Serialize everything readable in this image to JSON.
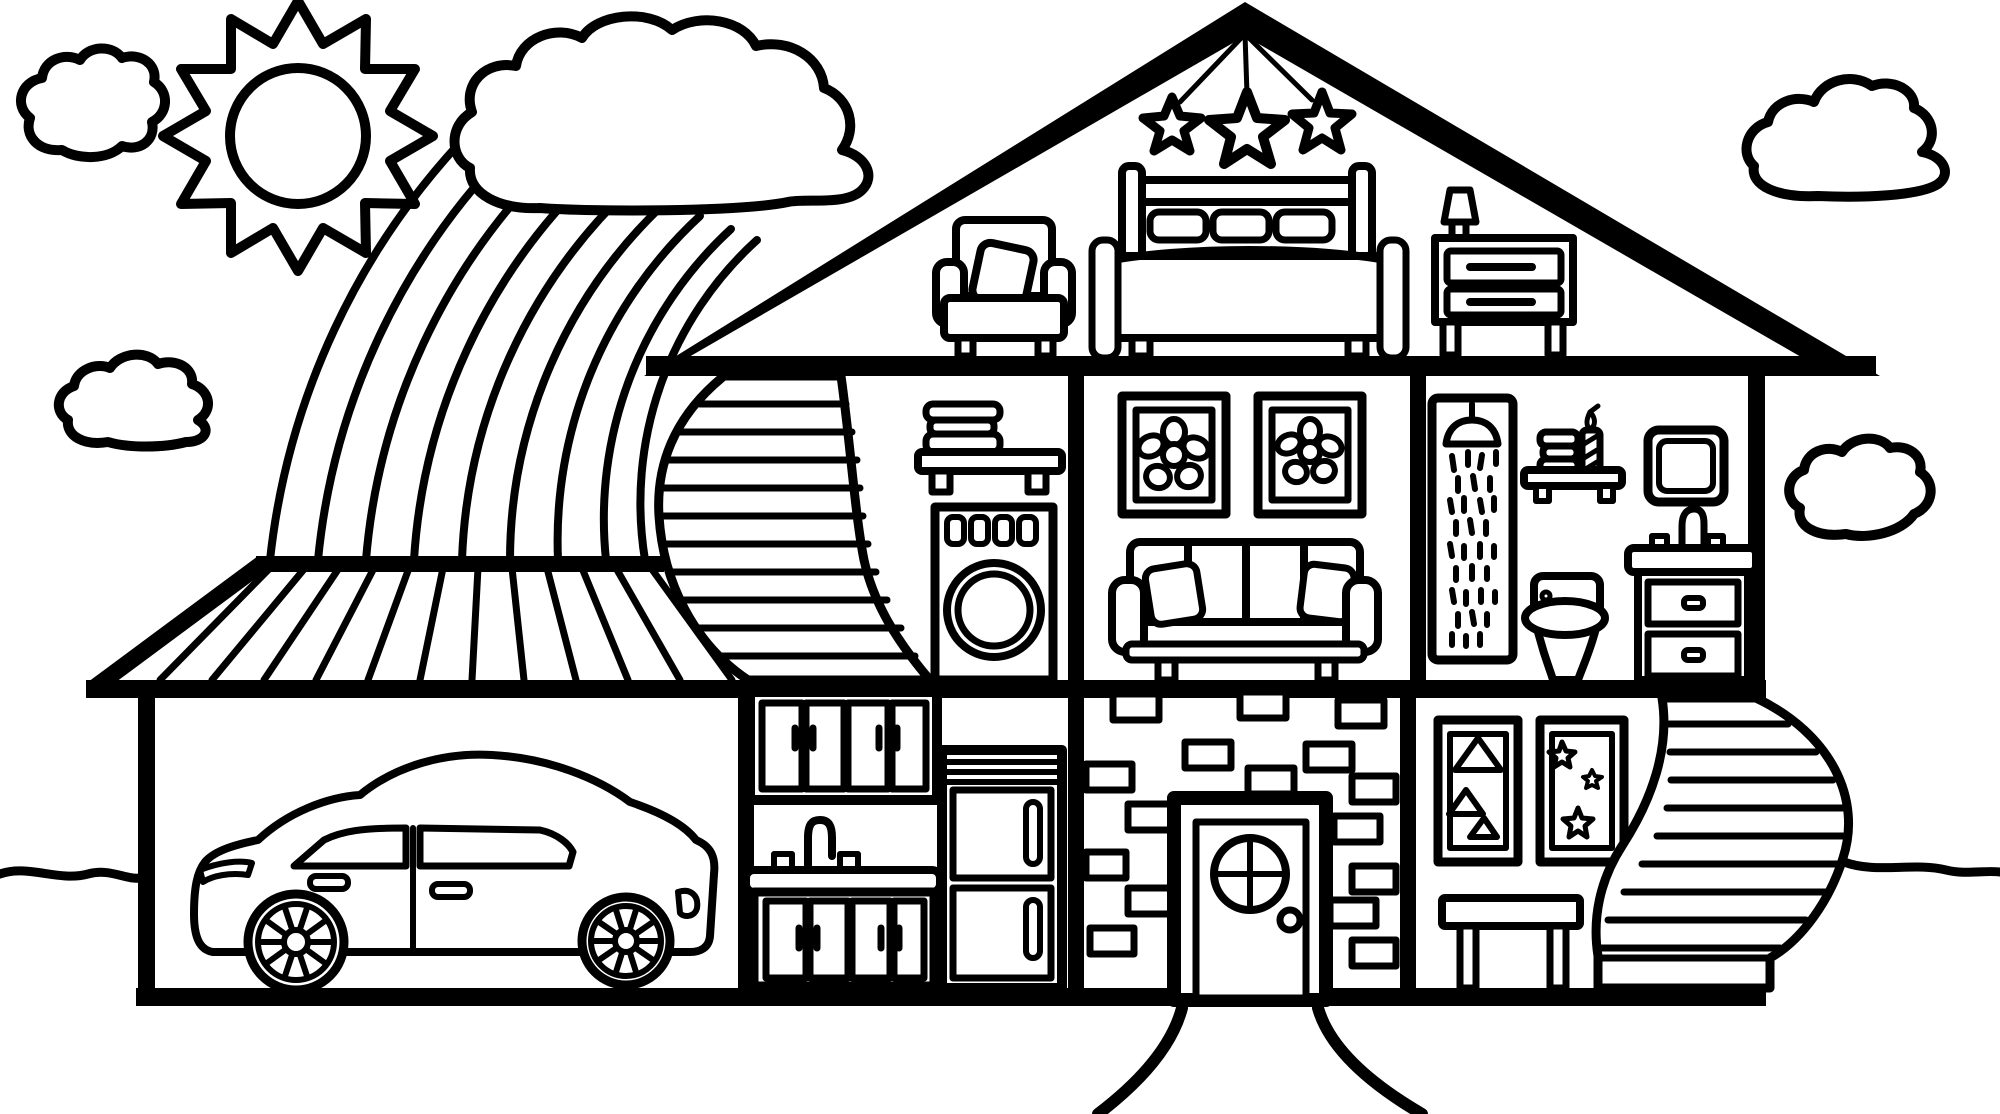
{
  "colors": {
    "line": "#000000",
    "background": "#ffffff"
  },
  "scene": {
    "description": "Black and white coloring-page line drawing of a cutaway dollhouse with attic bedroom, second floor rooms, ground floor rooms and a garage, with sun, clouds and a rainbow in the sky",
    "style": "thick black outlines on white, uncolored coloring book art",
    "sky": {
      "sun": "twelve-point spiky sun with round face, top left",
      "clouds": [
        "small puffy cloud top-left corner",
        "large cloud top-center above the rainbow",
        "small flat cloud mid-left",
        "large flat cloud top-right",
        "small puffy cloud mid-right beside bathroom"
      ],
      "rainbow": {
        "arc_count": 9,
        "from": "underside of the top-center cloud",
        "to": "garage roof ridge"
      }
    },
    "house": {
      "attic_bedroom": [
        "three hanging stars on strings from roof peak",
        "armchair with cushion",
        "double bed with headboard and three pillows",
        "nightstand with two drawers",
        "small table lamp"
      ],
      "second_floor": [
        "curved staircase up to attic",
        "wall shelf with folded towels",
        "front-loading washing machine with four buttons and round door",
        "two framed flower pictures",
        "three-seat sofa with two cushions",
        "shower stall with shower head and spraying water",
        "bathroom shelf with towels and striped candle",
        "toilet",
        "rounded square mirror",
        "sink vanity with faucet and two drawers"
      ],
      "ground_floor": [
        "garage with sedan car",
        "kitchen upper cabinets with four doors",
        "kitchen sink cabinet with faucet and two taps",
        "refrigerator with two doors and vertical handles",
        "brick entry wall",
        "front door with round four-pane window and doorknob",
        "framed picture with three triangles",
        "framed picture with three stars",
        "console table",
        "curved staircase down from second floor"
      ]
    },
    "outside": [
      "striped garage roof with ridge",
      "wavy ground line at left and right",
      "two curved walkway lines leading from the front door"
    ]
  }
}
